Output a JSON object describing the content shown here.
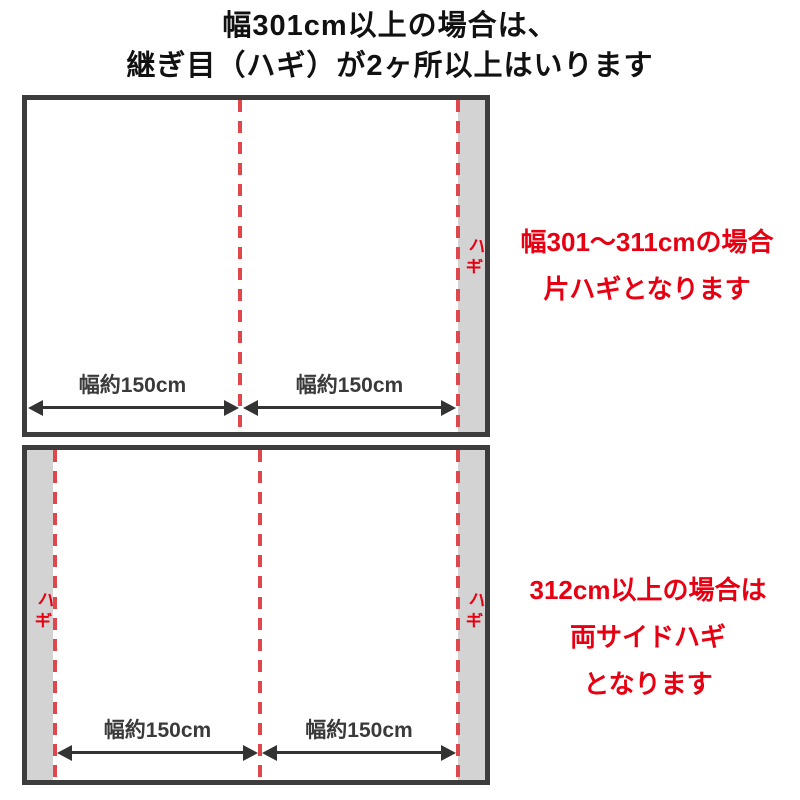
{
  "title": {
    "line1": "幅301cm以上の場合は、",
    "line2": "継ぎ目（ハギ）が2ヶ所以上はいります"
  },
  "colors": {
    "accent_red": "#e60012",
    "seam_dash_red": "#e0474d",
    "frame_border": "#3d3d3d",
    "seam_strip_gray": "#d3d3d3",
    "label_dark": "#3a3a3a"
  },
  "top_diagram": {
    "hagi_label": "ハギ",
    "left_width_label": "幅約150cm",
    "right_width_label": "幅約150cm",
    "annotation_line1": "幅301～311cmの場合",
    "annotation_line2": "片ハギとなります"
  },
  "bottom_diagram": {
    "left_hagi_label": "ハギ",
    "right_hagi_label": "ハギ",
    "left_width_label": "幅約150cm",
    "right_width_label": "幅約150cm",
    "annotation_line1": "312cm以上の場合は",
    "annotation_line2": "両サイドハギ",
    "annotation_line3": "となります"
  }
}
